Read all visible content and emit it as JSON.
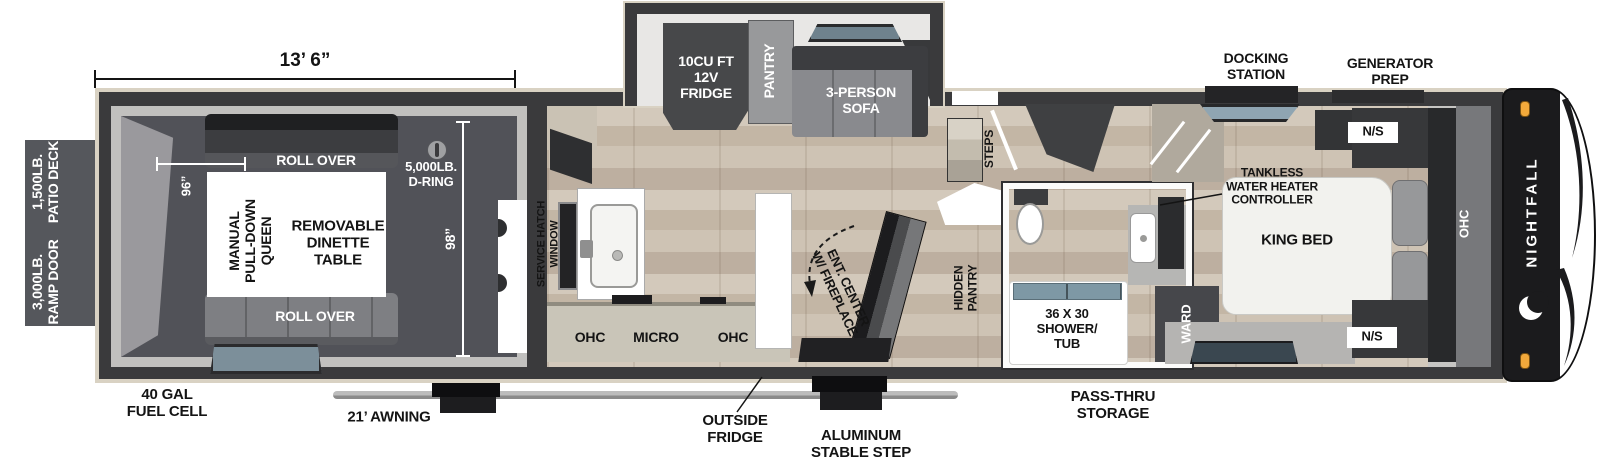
{
  "brand": "NIGHTFALL",
  "dimensions": {
    "overall_width": "13’ 6”",
    "garage_width": "96”",
    "garage_depth": "98”"
  },
  "exterior": {
    "patio_deck": "1,500LB.\nPATIO DECK",
    "ramp_door": "3,000LB.\nRAMP DOOR",
    "fuel_cell": "40 GAL\nFUEL CELL",
    "awning": "21’ AWNING",
    "outside_fridge": "OUTSIDE\nFRIDGE",
    "stable_step": "ALUMINUM\nSTABLE STEP",
    "pass_thru_storage": "PASS-THRU\nSTORAGE",
    "docking_station": "DOCKING\nSTATION",
    "generator_prep": "GENERATOR\nPREP"
  },
  "garage": {
    "roll_over_top": "ROLL OVER",
    "roll_over_bottom": "ROLL OVER",
    "queen_bed": "MANUAL\nPULL-DOWN\nQUEEN",
    "dinette": "REMOVABLE\nDINETTE\nTABLE",
    "d_ring": "5,000LB.\nD-RING"
  },
  "kitchen": {
    "service_hatch_window": "SERVICE HATCH\nWINDOW",
    "ohc_left": "OHC",
    "micro": "MICRO",
    "ohc_right": "OHC",
    "fridge": "10CU FT\n12V\nFRIDGE",
    "pantry": "PANTRY",
    "sofa": "3-PERSON\nSOFA",
    "ent_center": "ENT. CENTER\nW/ FIREPLACE",
    "hidden_pantry": "HIDDEN\nPANTRY",
    "steps": "STEPS"
  },
  "bathroom": {
    "shower_tub": "36 X 30\nSHOWER/\nTUB",
    "wardrobe": "WARD"
  },
  "bedroom": {
    "king_bed": "KING BED",
    "tankless_controller": "TANKLESS\nWATER HEATER\nCONTROLLER",
    "nightstand_top": "N/S",
    "nightstand_bottom": "N/S",
    "ohc": "OHC"
  },
  "colors": {
    "wall": "#3a3a3c",
    "trim": "#d9d2c3",
    "garage_floor": "#515258",
    "wood_floor": "#cdc2b2",
    "marker_light": "#f2a93b",
    "window_glass": "#7e98a5"
  }
}
